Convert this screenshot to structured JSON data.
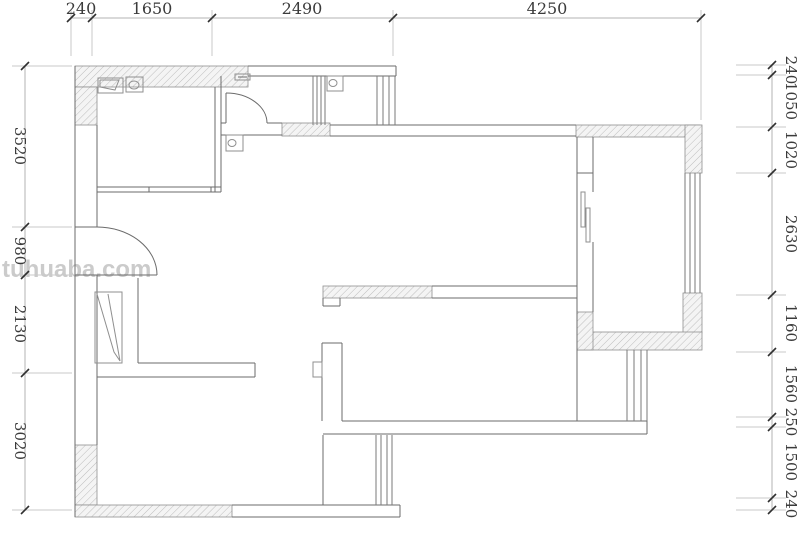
{
  "canvas": {
    "w": 800,
    "h": 540,
    "bg": "#ffffff"
  },
  "watermark": {
    "text": "tuhuaba.com",
    "color": "#cbcbcb",
    "x": 2,
    "y": 256,
    "size": 24
  },
  "styles": {
    "wall_line": "#6b6b6b",
    "window_line": "#7a7a7a",
    "fixture_line": "#8f8f8f",
    "hatch_border": "#909090",
    "hatch_stroke": "#bdbdbd",
    "hatch_fill": "#f4f4f4",
    "dim_line": "#b3b3b3",
    "ext_line": "#c9c9c9",
    "tick": "#2f2f2f",
    "dim_text": "#3b3b3b"
  },
  "dims": {
    "top": {
      "orientation": "horizontal",
      "line_y": 18,
      "x1": 71,
      "x2": 701,
      "ticks": [
        71,
        92,
        212,
        393,
        701
      ],
      "ext": [
        [
          10,
          56
        ],
        [
          10,
          56
        ],
        [
          10,
          56
        ],
        [
          10,
          56
        ],
        [
          10,
          120
        ]
      ],
      "labels": [
        {
          "text": "240",
          "c": 81
        },
        {
          "text": "1650",
          "c": 152
        },
        {
          "text": "2490",
          "c": 302
        },
        {
          "text": "4250",
          "c": 547
        }
      ],
      "values_mm": [
        240,
        1650,
        2490,
        4250
      ],
      "text_y": 14,
      "font": 16
    },
    "left": {
      "orientation": "vertical",
      "line_x": 25,
      "y1": 66,
      "y2": 510,
      "ticks": [
        66,
        227,
        275,
        373,
        510
      ],
      "ext_x": [
        12,
        72
      ],
      "labels": [
        {
          "text": "3520",
          "c": 146
        },
        {
          "text": "980",
          "c": 251
        },
        {
          "text": "2130",
          "c": 324
        },
        {
          "text": "3020",
          "c": 441
        }
      ],
      "values_mm": [
        3520,
        980,
        2130,
        3020
      ],
      "text_x": 15,
      "font": 15
    },
    "right": {
      "orientation": "vertical",
      "line_x": 772,
      "y1": 65,
      "y2": 510,
      "ticks": [
        65,
        75,
        127,
        173,
        295,
        352,
        417,
        427,
        498,
        510
      ],
      "ext_x": [
        736,
        786
      ],
      "labels": [
        {
          "text": "240",
          "c": 70
        },
        {
          "text": "1050",
          "c": 101
        },
        {
          "text": "1020",
          "c": 150
        },
        {
          "text": "2630",
          "c": 234
        },
        {
          "text": "1160",
          "c": 323
        },
        {
          "text": "1560",
          "c": 384
        },
        {
          "text": "250",
          "c": 422
        },
        {
          "text": "1500",
          "c": 462
        },
        {
          "text": "240",
          "c": 504
        }
      ],
      "values_mm": [
        240,
        1050,
        1020,
        2630,
        1160,
        1560,
        250,
        1500,
        240
      ],
      "text_x": 786,
      "font": 15
    }
  },
  "plan": {
    "hatches": [
      {
        "name": "top-wall-left",
        "x": 75,
        "y": 66,
        "w": 173,
        "h": 21
      },
      {
        "name": "left-wall-top",
        "x": 75,
        "y": 87,
        "w": 22,
        "h": 38
      },
      {
        "name": "left-wall-bottom",
        "x": 75,
        "y": 445,
        "w": 22,
        "h": 60
      },
      {
        "name": "bottom-wall-left",
        "x": 75,
        "y": 505,
        "w": 157,
        "h": 12
      },
      {
        "name": "mid-wall-segment",
        "x": 282,
        "y": 123,
        "w": 48,
        "h": 13
      },
      {
        "name": "bed2-top-wall",
        "x": 323,
        "y": 286,
        "w": 109,
        "h": 12
      },
      {
        "name": "right-top-wall",
        "x": 576,
        "y": 125,
        "w": 124,
        "h": 12
      },
      {
        "name": "right-top-corner",
        "x": 685,
        "y": 125,
        "w": 17,
        "h": 48
      },
      {
        "name": "right-mid-block",
        "x": 683,
        "y": 293,
        "w": 19,
        "h": 40
      },
      {
        "name": "master-bottom-wall",
        "x": 578,
        "y": 332,
        "w": 124,
        "h": 18
      },
      {
        "name": "master-left-foot",
        "x": 577,
        "y": 312,
        "w": 16,
        "h": 38
      }
    ],
    "lines": [
      [
        75,
        66,
        75,
        517
      ],
      [
        97,
        125,
        97,
        227
      ],
      [
        97,
        275,
        97,
        445
      ],
      [
        75,
        227,
        97,
        227
      ],
      [
        75,
        275,
        97,
        275
      ],
      [
        248,
        66,
        396,
        66
      ],
      [
        248,
        76,
        396,
        76
      ],
      [
        396,
        66,
        396,
        76
      ],
      [
        215,
        87,
        215,
        192
      ],
      [
        221,
        76,
        221,
        192
      ],
      [
        97,
        187,
        221,
        187
      ],
      [
        97,
        192,
        221,
        192
      ],
      [
        149,
        187,
        149,
        192
      ],
      [
        211,
        187,
        211,
        192
      ],
      [
        221,
        123,
        226,
        123
      ],
      [
        267,
        123,
        282,
        123
      ],
      [
        221,
        135,
        282,
        135
      ],
      [
        330,
        125,
        576,
        125
      ],
      [
        330,
        136,
        576,
        136
      ],
      [
        226,
        93,
        226,
        123
      ],
      [
        577,
        137,
        577,
        421
      ],
      [
        593,
        137,
        593,
        192
      ],
      [
        593,
        242,
        593,
        312
      ],
      [
        577,
        173,
        593,
        173
      ],
      [
        432,
        286,
        577,
        286
      ],
      [
        432,
        298,
        577,
        298
      ],
      [
        322,
        343,
        322,
        421
      ],
      [
        342,
        343,
        342,
        421
      ],
      [
        322,
        343,
        342,
        343
      ],
      [
        323,
        435,
        323,
        505
      ],
      [
        138,
        363,
        255,
        363
      ],
      [
        97,
        377,
        255,
        377
      ],
      [
        255,
        363,
        255,
        377
      ],
      [
        138,
        278,
        138,
        363
      ],
      [
        342,
        421,
        647,
        421
      ],
      [
        323,
        434,
        647,
        434
      ],
      [
        647,
        350,
        647,
        434
      ],
      [
        232,
        505,
        400,
        505
      ],
      [
        232,
        517,
        400,
        517
      ],
      [
        400,
        505,
        400,
        517
      ],
      [
        97,
        275,
        157,
        275
      ],
      [
        323,
        298,
        323,
        306
      ],
      [
        323,
        306,
        340,
        306
      ],
      [
        340,
        306,
        340,
        298
      ],
      [
        238,
        77,
        247,
        77
      ]
    ],
    "window_groups": [
      {
        "name": "wc-left-vent",
        "xs": [
          313,
          317,
          321,
          325
        ],
        "y1": 76,
        "y2": 125
      },
      {
        "name": "wc-right-vent",
        "xs": [
          377,
          383,
          389,
          395
        ],
        "y1": 76,
        "y2": 125
      },
      {
        "name": "master-right-window",
        "xs": [
          685,
          690,
          695,
          700
        ],
        "y1": 173,
        "y2": 293
      },
      {
        "name": "balcony-side-window",
        "xs": [
          627,
          634,
          641,
          647
        ],
        "y1": 350,
        "y2": 421
      },
      {
        "name": "bottom-bay-window",
        "xs": [
          376,
          381,
          387,
          392
        ],
        "y1": 435,
        "y2": 505
      }
    ],
    "doors": [
      {
        "name": "entry-door-arc",
        "sx": 157,
        "sy": 275,
        "rx": 60,
        "ry": 48,
        "ex": 97,
        "ey": 227,
        "sweep": 0
      },
      {
        "name": "corridor-door-arc",
        "sx": 226,
        "sy": 93,
        "rx": 41,
        "ry": 30,
        "ex": 267,
        "ey": 123,
        "sweep": 1
      }
    ],
    "rects": [
      {
        "name": "basin",
        "x": 98,
        "y": 78,
        "w": 25,
        "h": 15
      },
      {
        "name": "toilet-a",
        "x": 126,
        "y": 77,
        "w": 17,
        "h": 15
      },
      {
        "name": "toilet-b",
        "x": 327,
        "y": 76,
        "w": 16,
        "h": 15
      },
      {
        "name": "meter-box",
        "x": 226,
        "y": 135,
        "w": 17,
        "h": 16
      },
      {
        "name": "shoe-cabinet",
        "x": 95,
        "y": 292,
        "w": 27,
        "h": 71
      },
      {
        "name": "slider-leaf-1",
        "x": 581,
        "y": 192,
        "w": 4,
        "h": 35
      },
      {
        "name": "slider-leaf-2",
        "x": 586,
        "y": 208,
        "w": 4,
        "h": 34
      },
      {
        "name": "wall-tab",
        "x": 313,
        "y": 362,
        "w": 9,
        "h": 15
      },
      {
        "name": "vent-fixture",
        "x": 235,
        "y": 74,
        "w": 15,
        "h": 6
      }
    ],
    "ellipses": [
      {
        "name": "toilet-a-bowl",
        "cx": 134,
        "cy": 85,
        "rx": 5,
        "ry": 4
      },
      {
        "name": "toilet-b-bowl",
        "cx": 333,
        "cy": 83,
        "rx": 4,
        "ry": 3.5
      },
      {
        "name": "meter-dial",
        "cx": 232,
        "cy": 143,
        "rx": 4,
        "ry": 3.5
      }
    ],
    "polylines": [
      {
        "name": "basin-bowl",
        "pts": [
          [
            100,
            80
          ],
          [
            119,
            80
          ],
          [
            115,
            90
          ],
          [
            100,
            87
          ],
          [
            100,
            80
          ]
        ]
      },
      {
        "name": "cabinet-diagonal",
        "pts": [
          [
            97,
            294
          ],
          [
            114,
            352
          ],
          [
            120,
            361
          ]
        ]
      },
      {
        "name": "cabinet-diagonal-2",
        "pts": [
          [
            108,
            294
          ],
          [
            120,
            361
          ]
        ]
      }
    ]
  }
}
